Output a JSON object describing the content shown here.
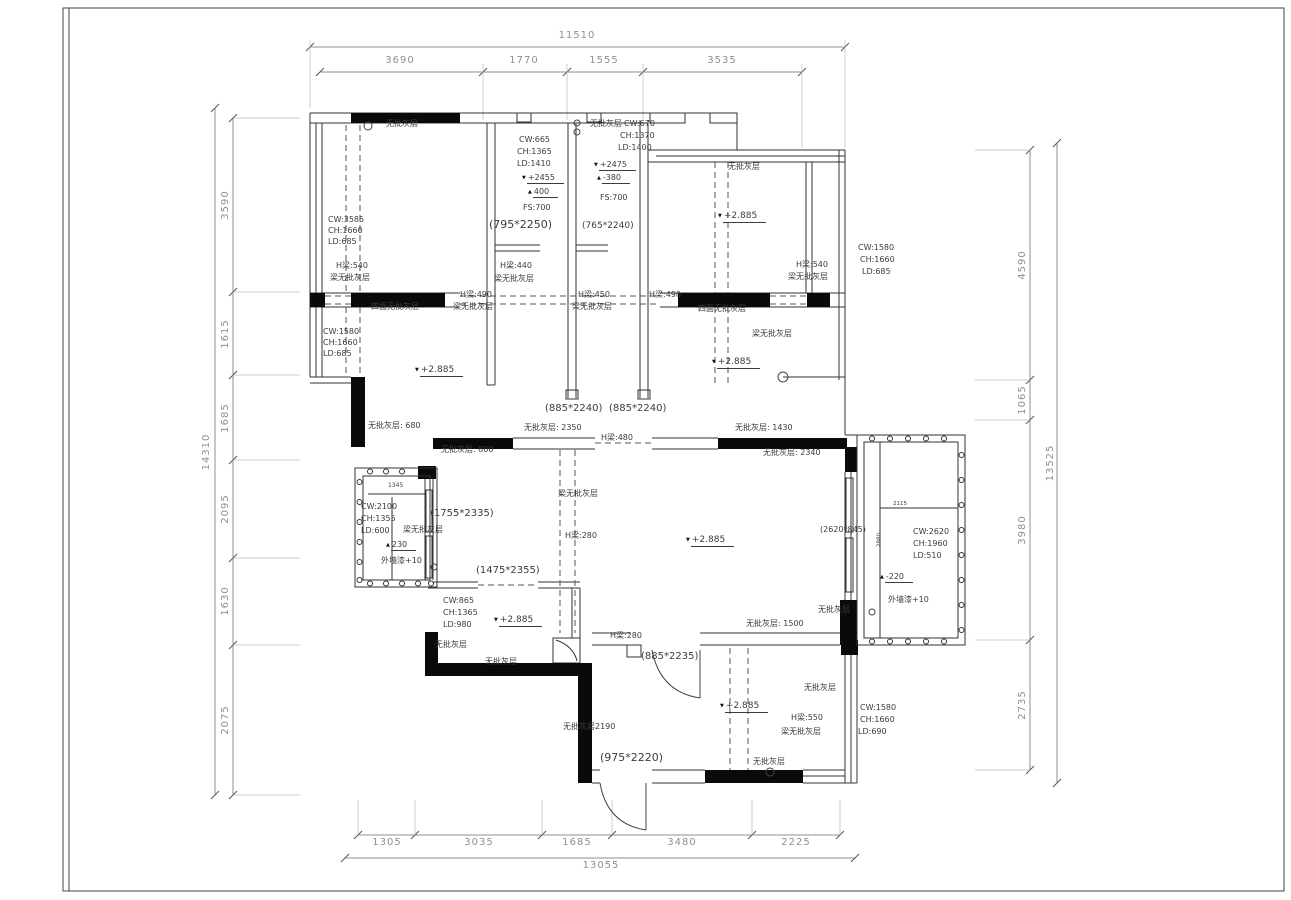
{
  "sheet": {
    "type": "architectural-floor-plan",
    "background": "#ffffff",
    "line_color": "#333333",
    "wall_fill": "#0a0a0a",
    "dim_color": "#8f8f8f"
  },
  "dimensions": {
    "top": {
      "total": "11510",
      "segments": [
        "3690",
        "1770",
        "1555",
        "3535"
      ]
    },
    "left": {
      "total": "14310",
      "segments": [
        "3590",
        "1615",
        "1685",
        "2095",
        "1630",
        "2075"
      ]
    },
    "right": {
      "total": "13525",
      "segments": [
        "4590",
        "1065",
        "3980",
        "2735"
      ]
    },
    "bottom": {
      "total": "13055",
      "segments": [
        "1305",
        "3035",
        "1685",
        "3480",
        "2225"
      ]
    }
  },
  "annotations": [
    {
      "x": 577,
      "y": 36,
      "t": "11510",
      "k": "dim",
      "c": 1
    },
    {
      "x": 400,
      "y": 61,
      "t": "3690",
      "k": "dim",
      "c": 1
    },
    {
      "x": 524,
      "y": 61,
      "t": "1770",
      "k": "dim",
      "c": 1
    },
    {
      "x": 604,
      "y": 61,
      "t": "1555",
      "k": "dim",
      "c": 1
    },
    {
      "x": 722,
      "y": 61,
      "t": "3535",
      "k": "dim",
      "c": 1
    },
    {
      "x": 207,
      "y": 452,
      "t": "14310",
      "k": "dim",
      "r": 1
    },
    {
      "x": 226,
      "y": 205,
      "t": "3590",
      "k": "dim",
      "r": 1
    },
    {
      "x": 226,
      "y": 334,
      "t": "1615",
      "k": "dim",
      "r": 1
    },
    {
      "x": 226,
      "y": 418,
      "t": "1685",
      "k": "dim",
      "r": 1
    },
    {
      "x": 226,
      "y": 509,
      "t": "2095",
      "k": "dim",
      "r": 1
    },
    {
      "x": 226,
      "y": 601,
      "t": "1630",
      "k": "dim",
      "r": 1
    },
    {
      "x": 226,
      "y": 720,
      "t": "2075",
      "k": "dim",
      "r": 1
    },
    {
      "x": 1023,
      "y": 265,
      "t": "4590",
      "k": "dim",
      "r": 1
    },
    {
      "x": 1023,
      "y": 400,
      "t": "1065",
      "k": "dim",
      "r": 1
    },
    {
      "x": 1023,
      "y": 530,
      "t": "3980",
      "k": "dim",
      "r": 1
    },
    {
      "x": 1023,
      "y": 705,
      "t": "2735",
      "k": "dim",
      "r": 1
    },
    {
      "x": 1051,
      "y": 463,
      "t": "13525",
      "k": "dim",
      "r": 1
    },
    {
      "x": 387,
      "y": 843,
      "t": "1305",
      "k": "dim",
      "c": 1
    },
    {
      "x": 479,
      "y": 843,
      "t": "3035",
      "k": "dim",
      "c": 1
    },
    {
      "x": 577,
      "y": 843,
      "t": "1685",
      "k": "dim",
      "c": 1
    },
    {
      "x": 682,
      "y": 843,
      "t": "3480",
      "k": "dim",
      "c": 1
    },
    {
      "x": 796,
      "y": 843,
      "t": "2225",
      "k": "dim",
      "c": 1
    },
    {
      "x": 601,
      "y": 866,
      "t": "13055",
      "k": "dim",
      "c": 1
    },
    {
      "x": 386,
      "y": 120,
      "t": "无批灰层"
    },
    {
      "x": 328,
      "y": 216,
      "t": "CW:3585"
    },
    {
      "x": 328,
      "y": 227,
      "t": "CH:1660"
    },
    {
      "x": 328,
      "y": 238,
      "t": "LD:685"
    },
    {
      "x": 336,
      "y": 262,
      "t": "H梁:540"
    },
    {
      "x": 330,
      "y": 274,
      "t": "梁无批灰层"
    },
    {
      "x": 519,
      "y": 136,
      "t": "CW:665"
    },
    {
      "x": 517,
      "y": 148,
      "t": "CH:1365"
    },
    {
      "x": 517,
      "y": 160,
      "t": "LD:1410"
    },
    {
      "x": 522,
      "y": 174,
      "t": "+2455",
      "u": 1,
      "m": "▼"
    },
    {
      "x": 528,
      "y": 188,
      "t": "400",
      "u": 1,
      "m": "▲"
    },
    {
      "x": 523,
      "y": 204,
      "t": "FS:700"
    },
    {
      "x": 489,
      "y": 219,
      "t": "(795*2250)",
      "f": 11
    },
    {
      "x": 590,
      "y": 120,
      "t": "无批灰层"
    },
    {
      "x": 624,
      "y": 120,
      "t": "CW:670"
    },
    {
      "x": 620,
      "y": 132,
      "t": "CH:1370"
    },
    {
      "x": 618,
      "y": 144,
      "t": "LD:1400"
    },
    {
      "x": 594,
      "y": 161,
      "t": "+2475",
      "u": 1,
      "m": "▼"
    },
    {
      "x": 597,
      "y": 174,
      "t": "-380",
      "u": 1,
      "m": "▲"
    },
    {
      "x": 600,
      "y": 194,
      "t": "FS:700"
    },
    {
      "x": 582,
      "y": 222,
      "t": "(765*2240)",
      "f": 9
    },
    {
      "x": 728,
      "y": 163,
      "t": "无批灰层"
    },
    {
      "x": 718,
      "y": 212,
      "t": "+2.885",
      "u": 1,
      "m": "▼",
      "f": 9
    },
    {
      "x": 858,
      "y": 244,
      "t": "CW:1580"
    },
    {
      "x": 860,
      "y": 256,
      "t": "CH:1660"
    },
    {
      "x": 862,
      "y": 268,
      "t": "LD:685"
    },
    {
      "x": 796,
      "y": 261,
      "t": "H梁:540"
    },
    {
      "x": 788,
      "y": 273,
      "t": "梁无批灰层"
    },
    {
      "x": 500,
      "y": 262,
      "t": "H梁:440"
    },
    {
      "x": 494,
      "y": 275,
      "t": "梁无批灰层"
    },
    {
      "x": 460,
      "y": 291,
      "t": "H梁:490"
    },
    {
      "x": 453,
      "y": 303,
      "t": "梁无批灰层"
    },
    {
      "x": 371,
      "y": 303,
      "t": "四面无批灰层"
    },
    {
      "x": 578,
      "y": 291,
      "t": "H梁:450"
    },
    {
      "x": 572,
      "y": 303,
      "t": "梁无批灰层"
    },
    {
      "x": 649,
      "y": 291,
      "t": "H梁:490"
    },
    {
      "x": 698,
      "y": 305,
      "t": "四面无批灰层"
    },
    {
      "x": 323,
      "y": 328,
      "t": "CW:1580"
    },
    {
      "x": 323,
      "y": 339,
      "t": "CH:1660"
    },
    {
      "x": 323,
      "y": 350,
      "t": "LD:685"
    },
    {
      "x": 752,
      "y": 330,
      "t": "梁无批灰层"
    },
    {
      "x": 415,
      "y": 366,
      "t": "+2.885",
      "u": 1,
      "m": "▼",
      "f": 9
    },
    {
      "x": 712,
      "y": 358,
      "t": "+2.885",
      "u": 1,
      "m": "▼",
      "f": 9
    },
    {
      "x": 545,
      "y": 404,
      "t": "(885*2240)",
      "f": 10
    },
    {
      "x": 609,
      "y": 404,
      "t": "(885*2240)",
      "f": 10
    },
    {
      "x": 368,
      "y": 422,
      "t": "无批灰层: 680"
    },
    {
      "x": 524,
      "y": 424,
      "t": "无批灰层: 2350"
    },
    {
      "x": 601,
      "y": 434,
      "t": "H梁:480"
    },
    {
      "x": 735,
      "y": 424,
      "t": "无批灰层: 1430"
    },
    {
      "x": 441,
      "y": 446,
      "t": "无批灰层: 800"
    },
    {
      "x": 763,
      "y": 449,
      "t": "无批灰层: 2340"
    },
    {
      "x": 388,
      "y": 483,
      "t": "1345",
      "f": 6
    },
    {
      "x": 361,
      "y": 503,
      "t": "CW:2100"
    },
    {
      "x": 361,
      "y": 515,
      "t": "CH:1355"
    },
    {
      "x": 361,
      "y": 527,
      "t": "LD:600"
    },
    {
      "x": 403,
      "y": 526,
      "t": "梁无批灰层"
    },
    {
      "x": 430,
      "y": 509,
      "t": "(1755*2335)",
      "f": 10
    },
    {
      "x": 386,
      "y": 541,
      "t": "230",
      "u": 1,
      "m": "▲"
    },
    {
      "x": 381,
      "y": 557,
      "t": "外墙漆+10"
    },
    {
      "x": 476,
      "y": 566,
      "t": "(1475*2355)",
      "f": 10
    },
    {
      "x": 443,
      "y": 597,
      "t": "CW:865"
    },
    {
      "x": 443,
      "y": 609,
      "t": "CH:1365"
    },
    {
      "x": 443,
      "y": 621,
      "t": "LD:980"
    },
    {
      "x": 494,
      "y": 616,
      "t": "+2.885",
      "u": 1,
      "m": "▼",
      "f": 9
    },
    {
      "x": 435,
      "y": 641,
      "t": "无批灰层"
    },
    {
      "x": 485,
      "y": 658,
      "t": "无批灰层"
    },
    {
      "x": 558,
      "y": 490,
      "t": "梁无批灰层"
    },
    {
      "x": 565,
      "y": 532,
      "t": "H梁:280"
    },
    {
      "x": 686,
      "y": 536,
      "t": "+2.885",
      "u": 1,
      "m": "▼",
      "f": 9
    },
    {
      "x": 820,
      "y": 526,
      "t": "(2620*845)",
      "f": 8
    },
    {
      "x": 746,
      "y": 620,
      "t": "无批灰层: 1500"
    },
    {
      "x": 818,
      "y": 606,
      "t": "无批灰层"
    },
    {
      "x": 893,
      "y": 502,
      "t": "2115",
      "f": 5.5
    },
    {
      "x": 880,
      "y": 540,
      "t": "2880",
      "f": 5.5,
      "r": 1
    },
    {
      "x": 913,
      "y": 528,
      "t": "CW:2620"
    },
    {
      "x": 913,
      "y": 540,
      "t": "CH:1960"
    },
    {
      "x": 913,
      "y": 552,
      "t": "LD:510"
    },
    {
      "x": 880,
      "y": 573,
      "t": "-220",
      "u": 1,
      "m": "▲"
    },
    {
      "x": 888,
      "y": 596,
      "t": "外墙漆+10"
    },
    {
      "x": 610,
      "y": 632,
      "t": "H梁:280"
    },
    {
      "x": 641,
      "y": 652,
      "t": "(885*2235)",
      "f": 10
    },
    {
      "x": 720,
      "y": 702,
      "t": "+2.885",
      "u": 1,
      "m": "▼",
      "f": 9
    },
    {
      "x": 791,
      "y": 714,
      "t": "H梁:550"
    },
    {
      "x": 781,
      "y": 728,
      "t": "梁无批灰层"
    },
    {
      "x": 804,
      "y": 684,
      "t": "无批灰层"
    },
    {
      "x": 563,
      "y": 723,
      "t": "无批灰层2190"
    },
    {
      "x": 600,
      "y": 752,
      "t": "(975*2220)",
      "f": 11
    },
    {
      "x": 753,
      "y": 758,
      "t": "无批灰层"
    },
    {
      "x": 860,
      "y": 704,
      "t": "CW:1580"
    },
    {
      "x": 860,
      "y": 716,
      "t": "CH:1660"
    },
    {
      "x": 858,
      "y": 728,
      "t": "LD:690"
    }
  ]
}
